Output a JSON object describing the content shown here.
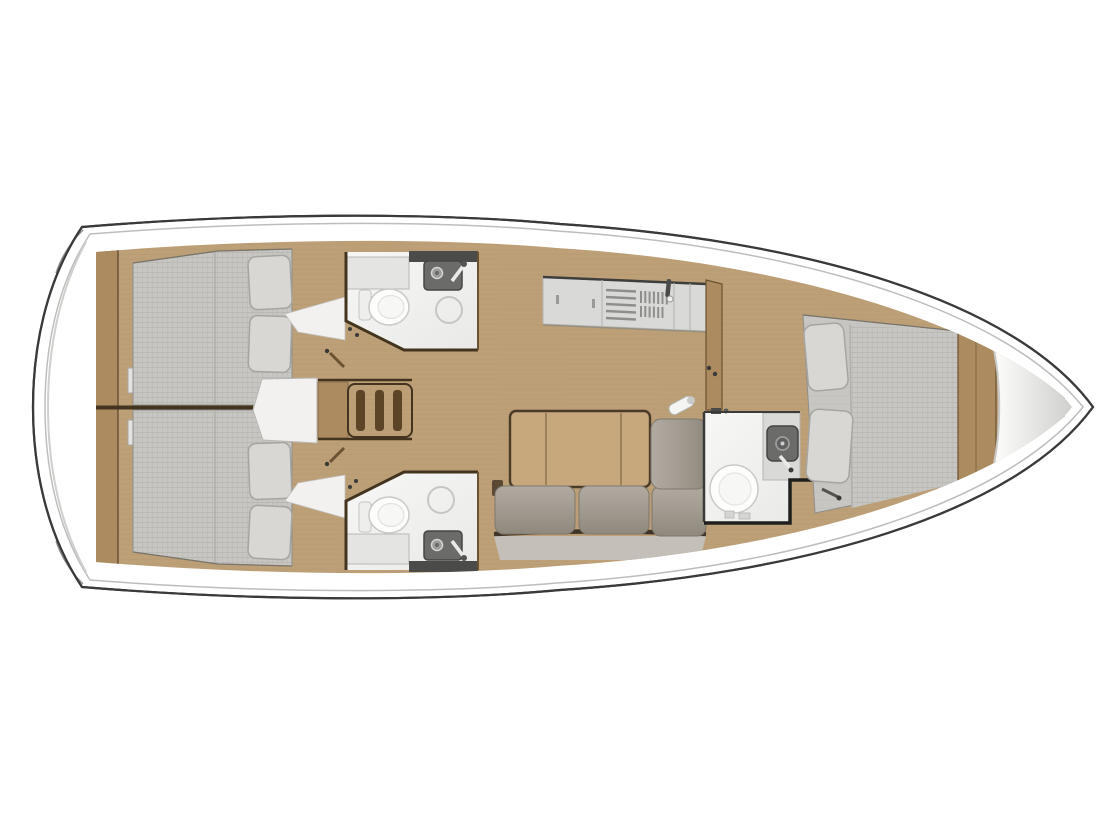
{
  "page": {
    "description": "Top-down interior layout plan of a sailing yacht, bow pointing right, stern at left",
    "view": "deck-plan",
    "background": "#ffffff"
  },
  "plan": {
    "orientation": {
      "bow": "right",
      "stern": "left"
    },
    "areas": [
      {
        "id": "stern-platform"
      },
      {
        "id": "aft-cabin-port",
        "features": [
          "double-berth",
          "two-pillows"
        ]
      },
      {
        "id": "aft-cabin-starboard",
        "features": [
          "double-berth",
          "two-pillows"
        ]
      },
      {
        "id": "companionway-stairs",
        "steps": 3
      },
      {
        "id": "head-port",
        "features": [
          "toilet",
          "sink",
          "shower-drain",
          "vanity"
        ]
      },
      {
        "id": "head-starboard",
        "features": [
          "toilet",
          "sink",
          "shower-drain",
          "vanity"
        ]
      },
      {
        "id": "galley",
        "features": [
          "stove",
          "sink-grate",
          "faucet",
          "cabinets"
        ]
      },
      {
        "id": "salon",
        "features": [
          "folding-table",
          "l-shaped-settee",
          "bottle"
        ]
      },
      {
        "id": "forward-head",
        "features": [
          "toilet",
          "sink",
          "faucet"
        ]
      },
      {
        "id": "forward-cabin",
        "features": [
          "v-berth",
          "two-pillows"
        ]
      },
      {
        "id": "bow-locker"
      }
    ]
  },
  "colors": {
    "hull-outline": "#3a3a3a",
    "deck-line": "#bdbdbb",
    "deck-fill": "#ffffff",
    "deck-shade": "#cfcfcd",
    "wood-floor": "#bda078",
    "wood-grain": "#a88c64",
    "wood-trim": "#ab8b5f",
    "wood-dark": "#6b5233",
    "wall-dark": "#43341f",
    "step-slot": "#5c4527",
    "mattress": "#c7c6c2",
    "mattress-line": "#b2b1ad",
    "pillow": "#d8d7d4",
    "pillow-edge": "#a6a5a1",
    "cushion-hi": "#b0aaa0",
    "cushion": "#a29c92",
    "cushion-lo": "#8f887d",
    "cushion-shadow": "#3f3428",
    "backrest": "#c4c0b9",
    "bath-floor": "#f7f7f5",
    "bath-floor-dim": "#e9e9e7",
    "bath-counter": "#e4e4e2",
    "dark-shelf": "#4b4b49",
    "counter-gray": "#d9d9d7",
    "metal": "#8e8e8c",
    "sink-dark": "#6b6b69",
    "sink-rim": "#454543",
    "fixture": "#fdfdfc",
    "fixture-edge": "#c9c9c7",
    "table-wood": "#c7a87d",
    "table-edge": "#4a3a28",
    "white-floor": "#f2f1ef",
    "bow-silver-a": "#fdfdfc",
    "bow-silver-b": "#cfcfcd"
  }
}
